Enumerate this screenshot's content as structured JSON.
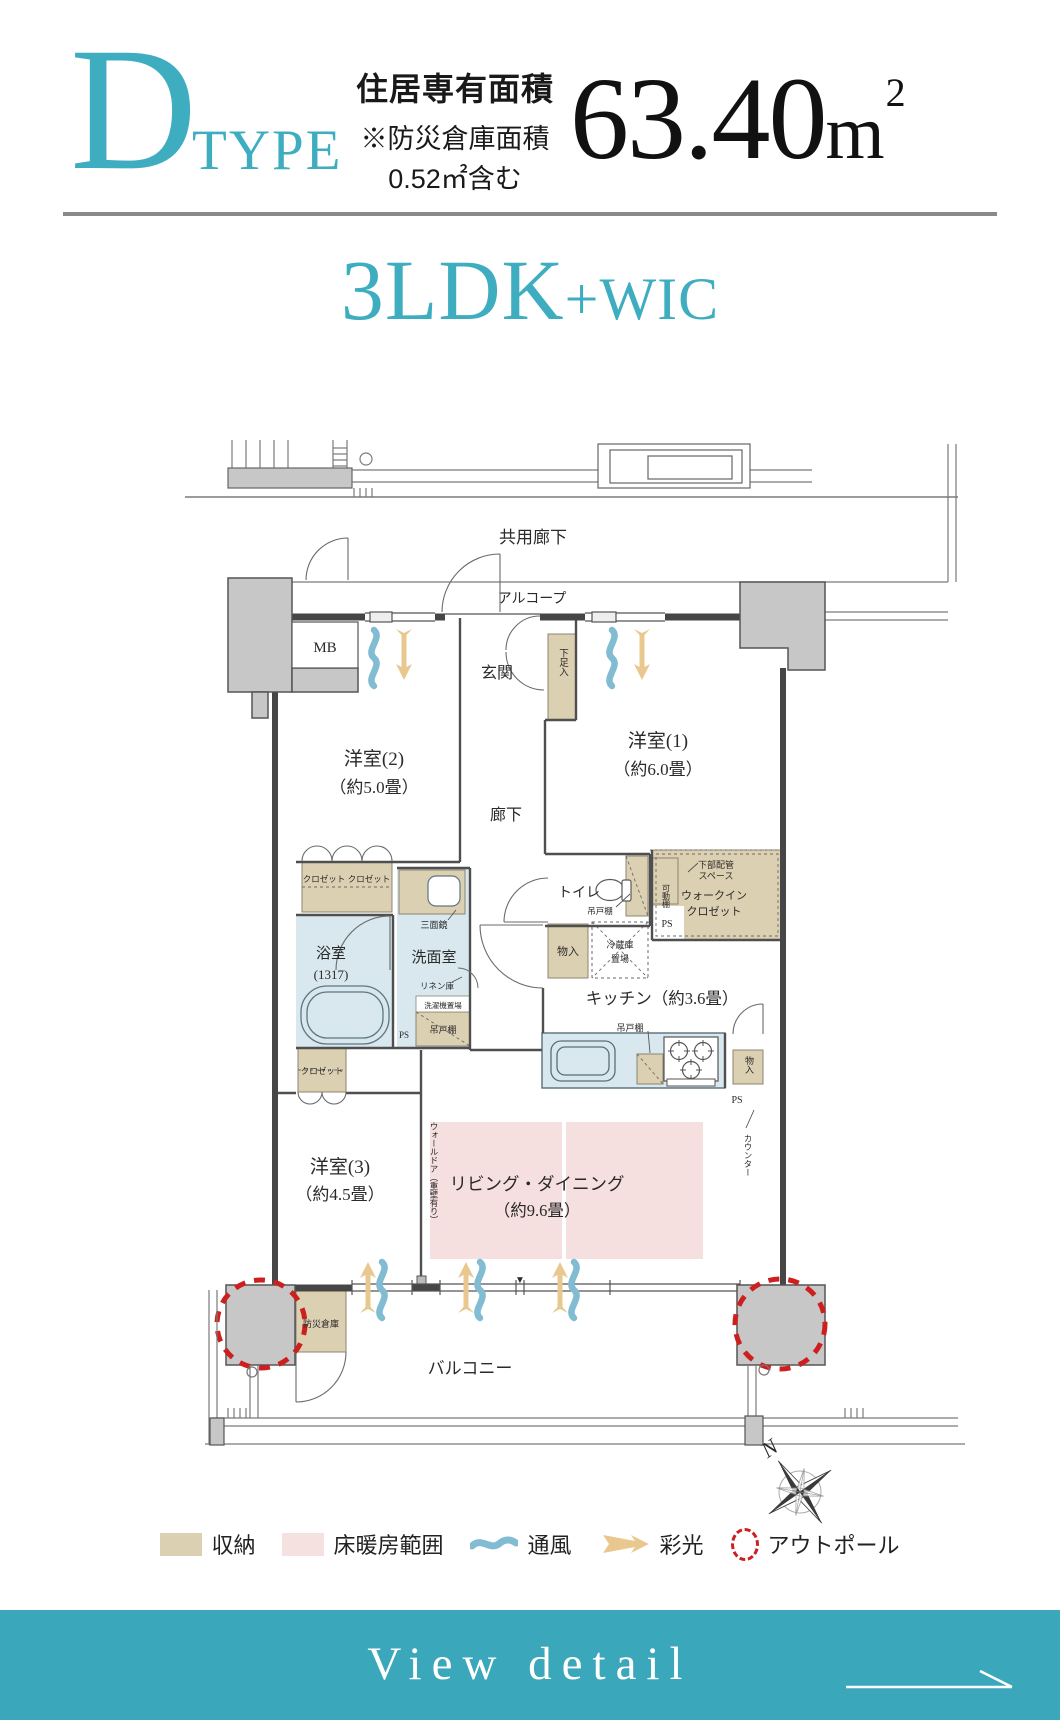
{
  "header": {
    "letter": "D",
    "type_label": "TYPE",
    "area_title": "住居専有面積",
    "area_note1": "※防災倉庫面積",
    "area_note2": "0.52㎡含む",
    "area_value": "63.40",
    "area_unit": "m",
    "area_sup": "2",
    "layout_main": "3LDK",
    "layout_plus": "+WIC"
  },
  "plan": {
    "kyoyo": "共用廊下",
    "alcove": "アルコープ",
    "mb": "MB",
    "genkan": "玄関",
    "shoe": "下足入",
    "room2": "洋室(2)",
    "room2s": "（約5.0畳）",
    "room1": "洋室(1)",
    "room1s": "（約6.0畳）",
    "hall": "廊下",
    "closet": "クロゼット",
    "toilet": "トイレ",
    "tsuri": "吊戸棚",
    "kadou": "可動棚",
    "pipe1": "下部配管",
    "pipe2": "スペース",
    "wic1": "ウォークイン",
    "wic2": "クロゼット",
    "ps": "PS",
    "mono": "物入",
    "fridge1": "冷蔵庫",
    "fridge2": "置場",
    "kitchen": "キッチン（約3.6畳）",
    "mirror": "三面鏡",
    "senmen": "洗面室",
    "linen": "リネン庫",
    "washer": "洗濯機置場",
    "bath": "浴室",
    "bathsize": "(1317)",
    "counter": "カウンター",
    "walldoor": "ウォールドア（重壁有り）",
    "room3": "洋室(3)",
    "room3s": "（約4.5畳）",
    "ld": "リビング・ダイニング",
    "lds": "（約9.6畳）",
    "bousai": "防災倉庫",
    "balcony": "バルコニー",
    "north": "N",
    "window_marker": "▼"
  },
  "legend": {
    "items": [
      {
        "label": "収納",
        "symbol": "beige-swatch"
      },
      {
        "label": "床暖房範囲",
        "symbol": "pink-swatch"
      },
      {
        "label": "通風",
        "symbol": "wave"
      },
      {
        "label": "彩光",
        "symbol": "arrow"
      },
      {
        "label": "アウトポール",
        "symbol": "red-dashed-circle"
      }
    ]
  },
  "cta": {
    "label": "View detail"
  },
  "colors": {
    "accent_teal": "#3fadc0",
    "cta_band": "#3aa7ba",
    "storage_beige": "#dcd0b2",
    "floorheat_pink": "#f5dfdf",
    "water_blue": "#d8e8ee",
    "pillar_gray": "#c7c7c7",
    "outpole_red": "#ce1f1f",
    "wave_teal": "#82bcd3",
    "daylight_tan": "#e8c88e"
  }
}
